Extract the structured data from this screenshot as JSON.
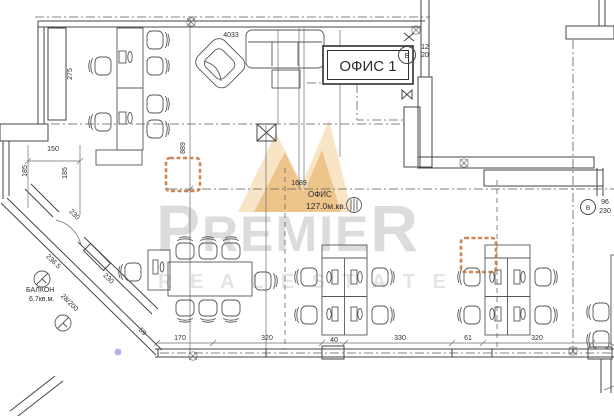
{
  "watermark": {
    "brand_p": "P",
    "brand_mid": "REMIE",
    "brand_r": "R",
    "tagline": "R E A L   E S T A T E",
    "brand_color": "#dcdcdc",
    "logo_color": "#e9a83e"
  },
  "plan": {
    "office_box_label": "ОФИС 1",
    "room_name": "ОФИС",
    "room_area": "127.0м.кв.",
    "balcony_name": "БАЛКОН",
    "balcony_area": "6.7кв.м.",
    "marker_top": "В",
    "marker_right": "В"
  },
  "colors": {
    "line": "#454545",
    "column_marker": "#c87137",
    "highlight_dot": "#b4a0e0"
  },
  "dimensions": [
    {
      "v": "275",
      "x": 72,
      "y": 74,
      "r": -90
    },
    {
      "v": "150",
      "x": 53,
      "y": 151,
      "r": 0
    },
    {
      "v": "185",
      "x": 27,
      "y": 171,
      "r": -90
    },
    {
      "v": "185",
      "x": 67,
      "y": 173,
      "r": -90
    },
    {
      "v": "889",
      "x": 185,
      "y": 148,
      "r": -90
    },
    {
      "v": "4033",
      "x": 231,
      "y": 37,
      "r": 0
    },
    {
      "v": "1689",
      "x": 299,
      "y": 185,
      "r": 0
    },
    {
      "v": "230",
      "x": 73,
      "y": 216,
      "r": 45
    },
    {
      "v": "236.5",
      "x": 52,
      "y": 263,
      "r": 45
    },
    {
      "v": "230",
      "x": 107,
      "y": 280,
      "r": 45
    },
    {
      "v": "28/200",
      "x": 68,
      "y": 304,
      "r": 45
    },
    {
      "v": "59",
      "x": 141,
      "y": 333,
      "r": 45
    },
    {
      "v": "170",
      "x": 180,
      "y": 340,
      "r": 0
    },
    {
      "v": "320",
      "x": 267,
      "y": 340,
      "r": 0
    },
    {
      "v": "40",
      "x": 334,
      "y": 342,
      "r": 0
    },
    {
      "v": "330",
      "x": 400,
      "y": 340,
      "r": 0
    },
    {
      "v": "61",
      "x": 468,
      "y": 340,
      "r": 0
    },
    {
      "v": "320",
      "x": 537,
      "y": 340,
      "r": 0
    },
    {
      "v": "12",
      "x": 425,
      "y": 49,
      "r": 0
    },
    {
      "v": "20",
      "x": 425,
      "y": 57,
      "r": 0
    },
    {
      "v": "96",
      "x": 605,
      "y": 204,
      "r": 0
    },
    {
      "v": "230",
      "x": 605,
      "y": 213,
      "r": 0
    }
  ]
}
